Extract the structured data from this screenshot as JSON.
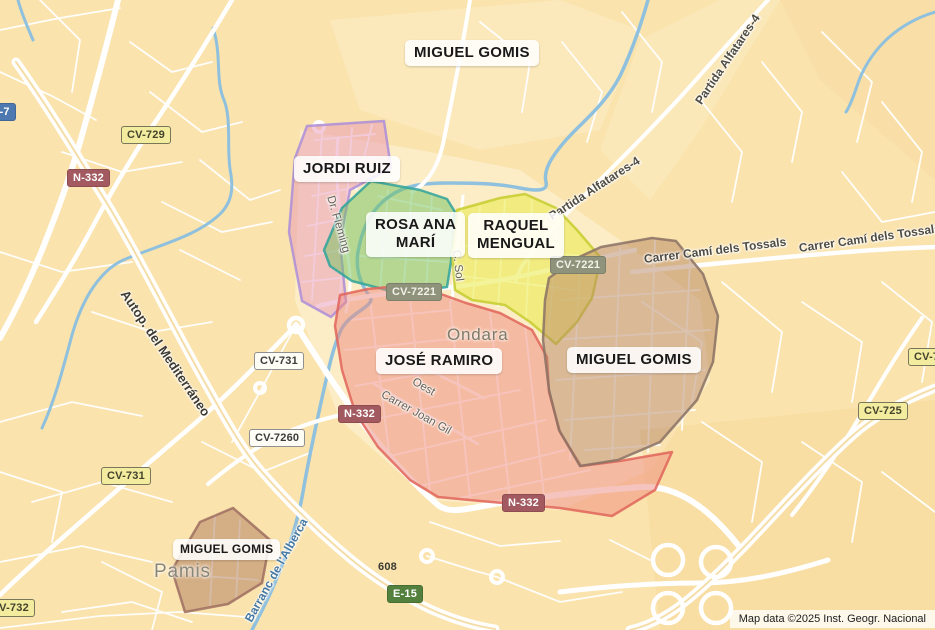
{
  "map": {
    "attribution": "Map data ©2025 Inst. Geogr. Nacional",
    "colors": {
      "land": "#fae3ad",
      "land_light": "#fceecb",
      "land_dark": "#f7d99b",
      "water": "#8fc0dd",
      "road": "#ffffff",
      "town_label": "#7e7b68",
      "street_label": "#666258",
      "water_label": "#4579a4"
    }
  },
  "towns": [
    {
      "name": "Ondara"
    },
    {
      "name": "Pamis"
    }
  ],
  "territories": [
    {
      "id": "miguel-gomis-north",
      "label": "MIGUEL GOMIS"
    },
    {
      "id": "jordi-ruiz",
      "label": "JORDI RUIZ",
      "fill": "#e897b8",
      "stroke": "#ab8ed8"
    },
    {
      "id": "rosa-ana-mari",
      "label_line1": "ROSA ANA",
      "label_line2": "MARÍ",
      "fill": "#6fc25e",
      "stroke": "#2fa39b"
    },
    {
      "id": "raquel-mengual",
      "label_line1": "RAQUEL",
      "label_line2": "MENGUAL",
      "fill": "#eae945",
      "stroke": "#c6cc2e"
    },
    {
      "id": "jose-ramiro",
      "label": "JOSÉ RAMIRO",
      "fill": "#ee8a7e",
      "stroke": "#e0655b"
    },
    {
      "id": "miguel-gomis-east",
      "label": "MIGUEL GOMIS",
      "fill": "#b58566",
      "stroke": "#8a7265"
    },
    {
      "id": "miguel-gomis-pamis",
      "label": "MIGUEL GOMIS",
      "fill": "#b58566",
      "stroke": "#9e6f60"
    }
  ],
  "shields": [
    {
      "label": "P-7",
      "type": "blue"
    },
    {
      "label": "CV-729",
      "type": "yellow"
    },
    {
      "label": "N-332",
      "type": "red"
    },
    {
      "label": "CV-731",
      "type": "white"
    },
    {
      "label": "CV-7260",
      "type": "white"
    },
    {
      "label": "CV-731",
      "type": "yellow"
    },
    {
      "label": "CV-732",
      "type": "yellow"
    },
    {
      "label": "CV-7221",
      "type": "olive"
    },
    {
      "label": "CV-7221",
      "type": "olive"
    },
    {
      "label": "N-332",
      "type": "red"
    },
    {
      "label": "N-332",
      "type": "red"
    },
    {
      "label": "E-15",
      "type": "green"
    },
    {
      "label": "608",
      "type": "plain"
    },
    {
      "label": "CV-725",
      "type": "yellow"
    },
    {
      "label": "CV-7",
      "type": "yellow"
    }
  ],
  "streets": [
    {
      "name": "Partida Alfatares-4"
    },
    {
      "name": "Partida Alfatares-4"
    },
    {
      "name": "Carrer Camí dels Tossals"
    },
    {
      "name": "Carrer Camí dels Tossals"
    },
    {
      "name": "Dr. Fleming"
    },
    {
      "name": "C. Sol"
    },
    {
      "name": "Oest"
    },
    {
      "name": "Carrer Joan Gil"
    },
    {
      "name": "Autop. del Mediterráneo"
    },
    {
      "name": "Barranc de l'Alberca"
    }
  ]
}
